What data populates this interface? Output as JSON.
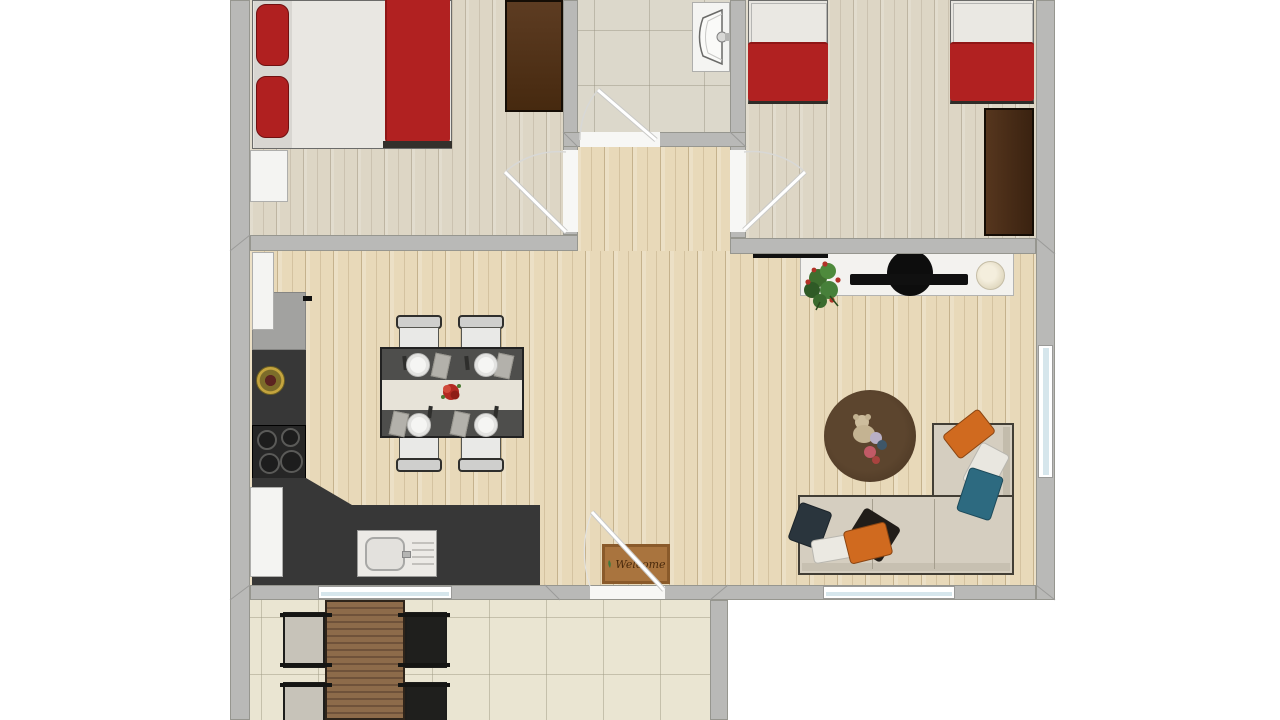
{
  "title": "apartment-floor-plan",
  "welcome_mat": {
    "text": "Welcome"
  },
  "rooms": [
    {
      "name": "bedroom-1",
      "position": "top-left"
    },
    {
      "name": "bathroom",
      "position": "top-center"
    },
    {
      "name": "bedroom-2",
      "position": "top-right"
    },
    {
      "name": "kitchen-dining",
      "position": "middle-left"
    },
    {
      "name": "living-room",
      "position": "middle-right"
    },
    {
      "name": "hallway",
      "position": "center"
    },
    {
      "name": "terrace",
      "position": "bottom-left"
    }
  ],
  "colors": {
    "wall": "#b9b9b7",
    "bedroom_floor": "#ddd6c5",
    "main_floor": "#e8d9b9",
    "bathroom_tile": "#dcd8cb",
    "terrace_tile": "#eae5d2",
    "bed_red": "#b12121",
    "wardrobe_brown": "#4a2c14",
    "counter_charcoal": "#373737",
    "sofa_beige": "#d5cec0",
    "pillow_orange": "#d06a1f",
    "pillow_teal": "#2d6a80",
    "rug_brown": "#4f3a26",
    "mat_brown": "#a9743e",
    "window_glass": "#d6e6ec"
  }
}
